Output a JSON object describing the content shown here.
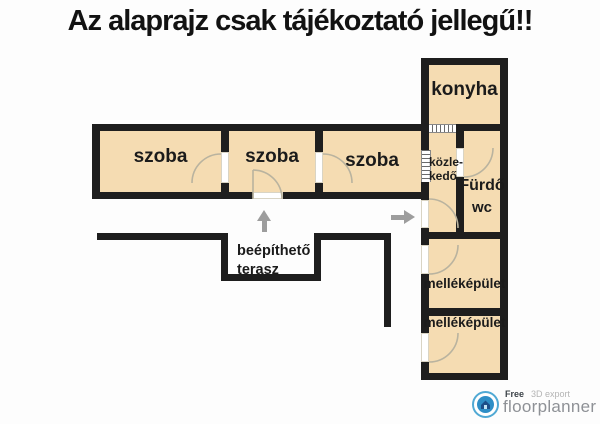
{
  "title": "Az alaprajz csak tájékoztató jellegű!!",
  "colors": {
    "room_fill": "#f5dcb2",
    "wall": "#1e1e1e",
    "door_arc": "#b9b39f",
    "arrow": "#9d9d9d",
    "logo_blue": "#2e8ec6",
    "logo_ring_blue": "#50a9d4"
  },
  "rooms": {
    "szoba1": {
      "label": "szoba"
    },
    "szoba2": {
      "label": "szoba"
    },
    "szoba3": {
      "label": "szoba"
    },
    "konyha": {
      "label": "konyha"
    },
    "kozlekedo": {
      "line1": "közle-",
      "line2": "kedő"
    },
    "furdo": {
      "line1": "Fürdő",
      "line2": "wc"
    },
    "mellekepulet1": {
      "label": "melléképület"
    },
    "mellekepulet2": {
      "label": "melléképület"
    }
  },
  "annotations": {
    "terasz_line1": "beépíthető",
    "terasz_line2": "terasz"
  },
  "footer": {
    "free_label": "Free",
    "export_label": "3D export",
    "brand": "floorplanner"
  }
}
